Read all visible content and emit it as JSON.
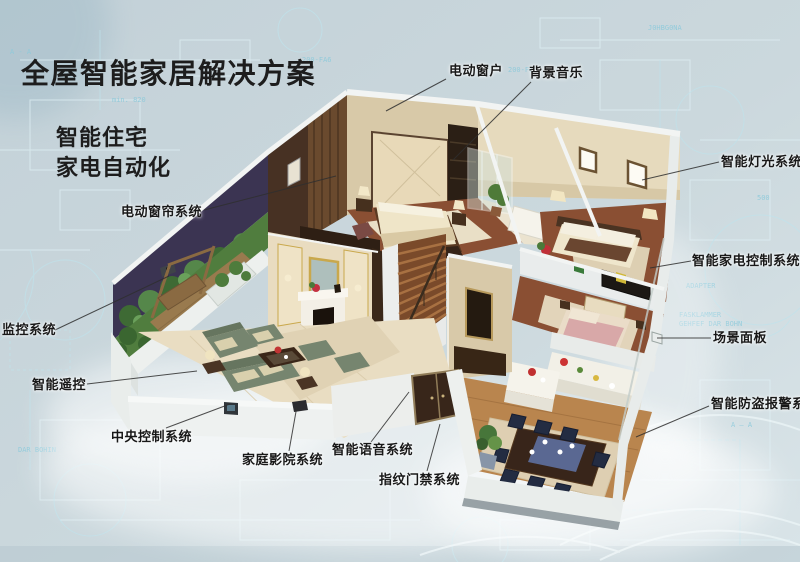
{
  "title": "全屋智能家居解决方案",
  "subtitles": {
    "line1": "智能住宅",
    "line2": "家电自动化"
  },
  "callouts": {
    "electric_window": {
      "text": "电动窗户"
    },
    "background_music": {
      "text": "背景音乐"
    },
    "smart_lighting": {
      "text": "智能灯光系统"
    },
    "appliance_control": {
      "text": "智能家电控制系统"
    },
    "scene_panel": {
      "text": "场景面板"
    },
    "burglar_alarm": {
      "text": "智能防盗报警系统"
    },
    "electric_curtain": {
      "text": "电动窗帘系统"
    },
    "monitoring": {
      "text": "监控系统"
    },
    "smart_remote": {
      "text": "智能遥控"
    },
    "central_control": {
      "text": "中央控制系统"
    },
    "home_theater": {
      "text": "家庭影院系统"
    },
    "smart_voice": {
      "text": "智能语音系统"
    },
    "fingerprint_access": {
      "text": "指纹门禁系统"
    }
  },
  "background_texts": [
    {
      "t": "200-FA6",
      "x": 302,
      "y": 62
    },
    {
      "t": "200-F60",
      "x": 508,
      "y": 72
    },
    {
      "t": "min. 820",
      "x": 112,
      "y": 102
    },
    {
      "t": "max. 965",
      "x": 344,
      "y": 422
    },
    {
      "t": "FASKLAMMER",
      "x": 679,
      "y": 317
    },
    {
      "t": "GEHFEF DAR BOHN",
      "x": 679,
      "y": 326
    },
    {
      "t": "ADAPTER",
      "x": 686,
      "y": 288
    },
    {
      "t": "A — A",
      "x": 731,
      "y": 427
    },
    {
      "t": "500",
      "x": 757,
      "y": 200
    },
    {
      "t": "J0HBG0NA",
      "x": 648,
      "y": 30
    },
    {
      "t": "A - A",
      "x": 10,
      "y": 54
    },
    {
      "t": "DAR BOHIN",
      "x": 18,
      "y": 452
    }
  ],
  "colors": {
    "background": "#c7d4da",
    "background_light": "#dae5e9",
    "blueprint_line": "#bfe3ec",
    "title": "#1d1d1d",
    "label": "#181818",
    "leader": "#2f2f2f",
    "wall_white": "#eef1f0",
    "floor_wood": "#8a4f33",
    "floor_marble": "#e9ddc2",
    "sofa_green": "#76856f",
    "accent_gold": "#c9a84c",
    "plant_green": "#4e7c3c",
    "balcony_wall": "#3b3452"
  }
}
